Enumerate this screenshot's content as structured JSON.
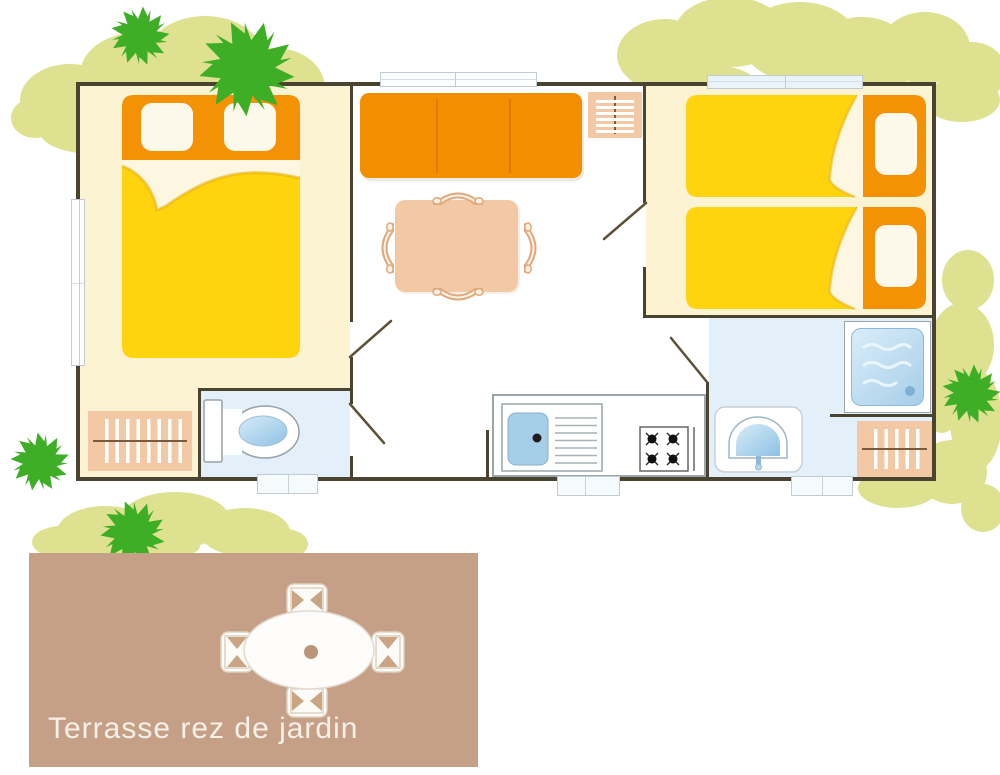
{
  "terrace": {
    "label": "Terrasse rez de jardin"
  },
  "rooms": {
    "bedroom_double": "double-bed bedroom",
    "living": "living-dining room",
    "bedroom_twin": "twin-bed bedroom",
    "toilet": "wc room",
    "bathroom": "shower room",
    "kitchen": "kitchenette"
  },
  "palette": {
    "wall": "#4A4330",
    "floor-cream": "#FBF3D1",
    "floor-blue": "#E3EFF9",
    "bed-yellow": "#FFD30D",
    "fold-cream": "#FDF7E2",
    "orange": "#F29204",
    "sofa-orange": "#F28E00",
    "pillow-cream": "#FDF9EA",
    "peach": "#F2C9A4",
    "peach-line": "#E2A87C",
    "rail-brown": "#7B5B3B",
    "water-blue": "#A7CEE9",
    "water-light": "#D9EDF9",
    "outline-gray": "#9BA6AC",
    "win-border": "#C2CBD1",
    "terrace-tan": "#C5A086",
    "terrace-text": "#F7F0E8",
    "bush-green": "#DEE18F",
    "tree-green": "#3FAE27",
    "door-line": "#5D5138"
  }
}
